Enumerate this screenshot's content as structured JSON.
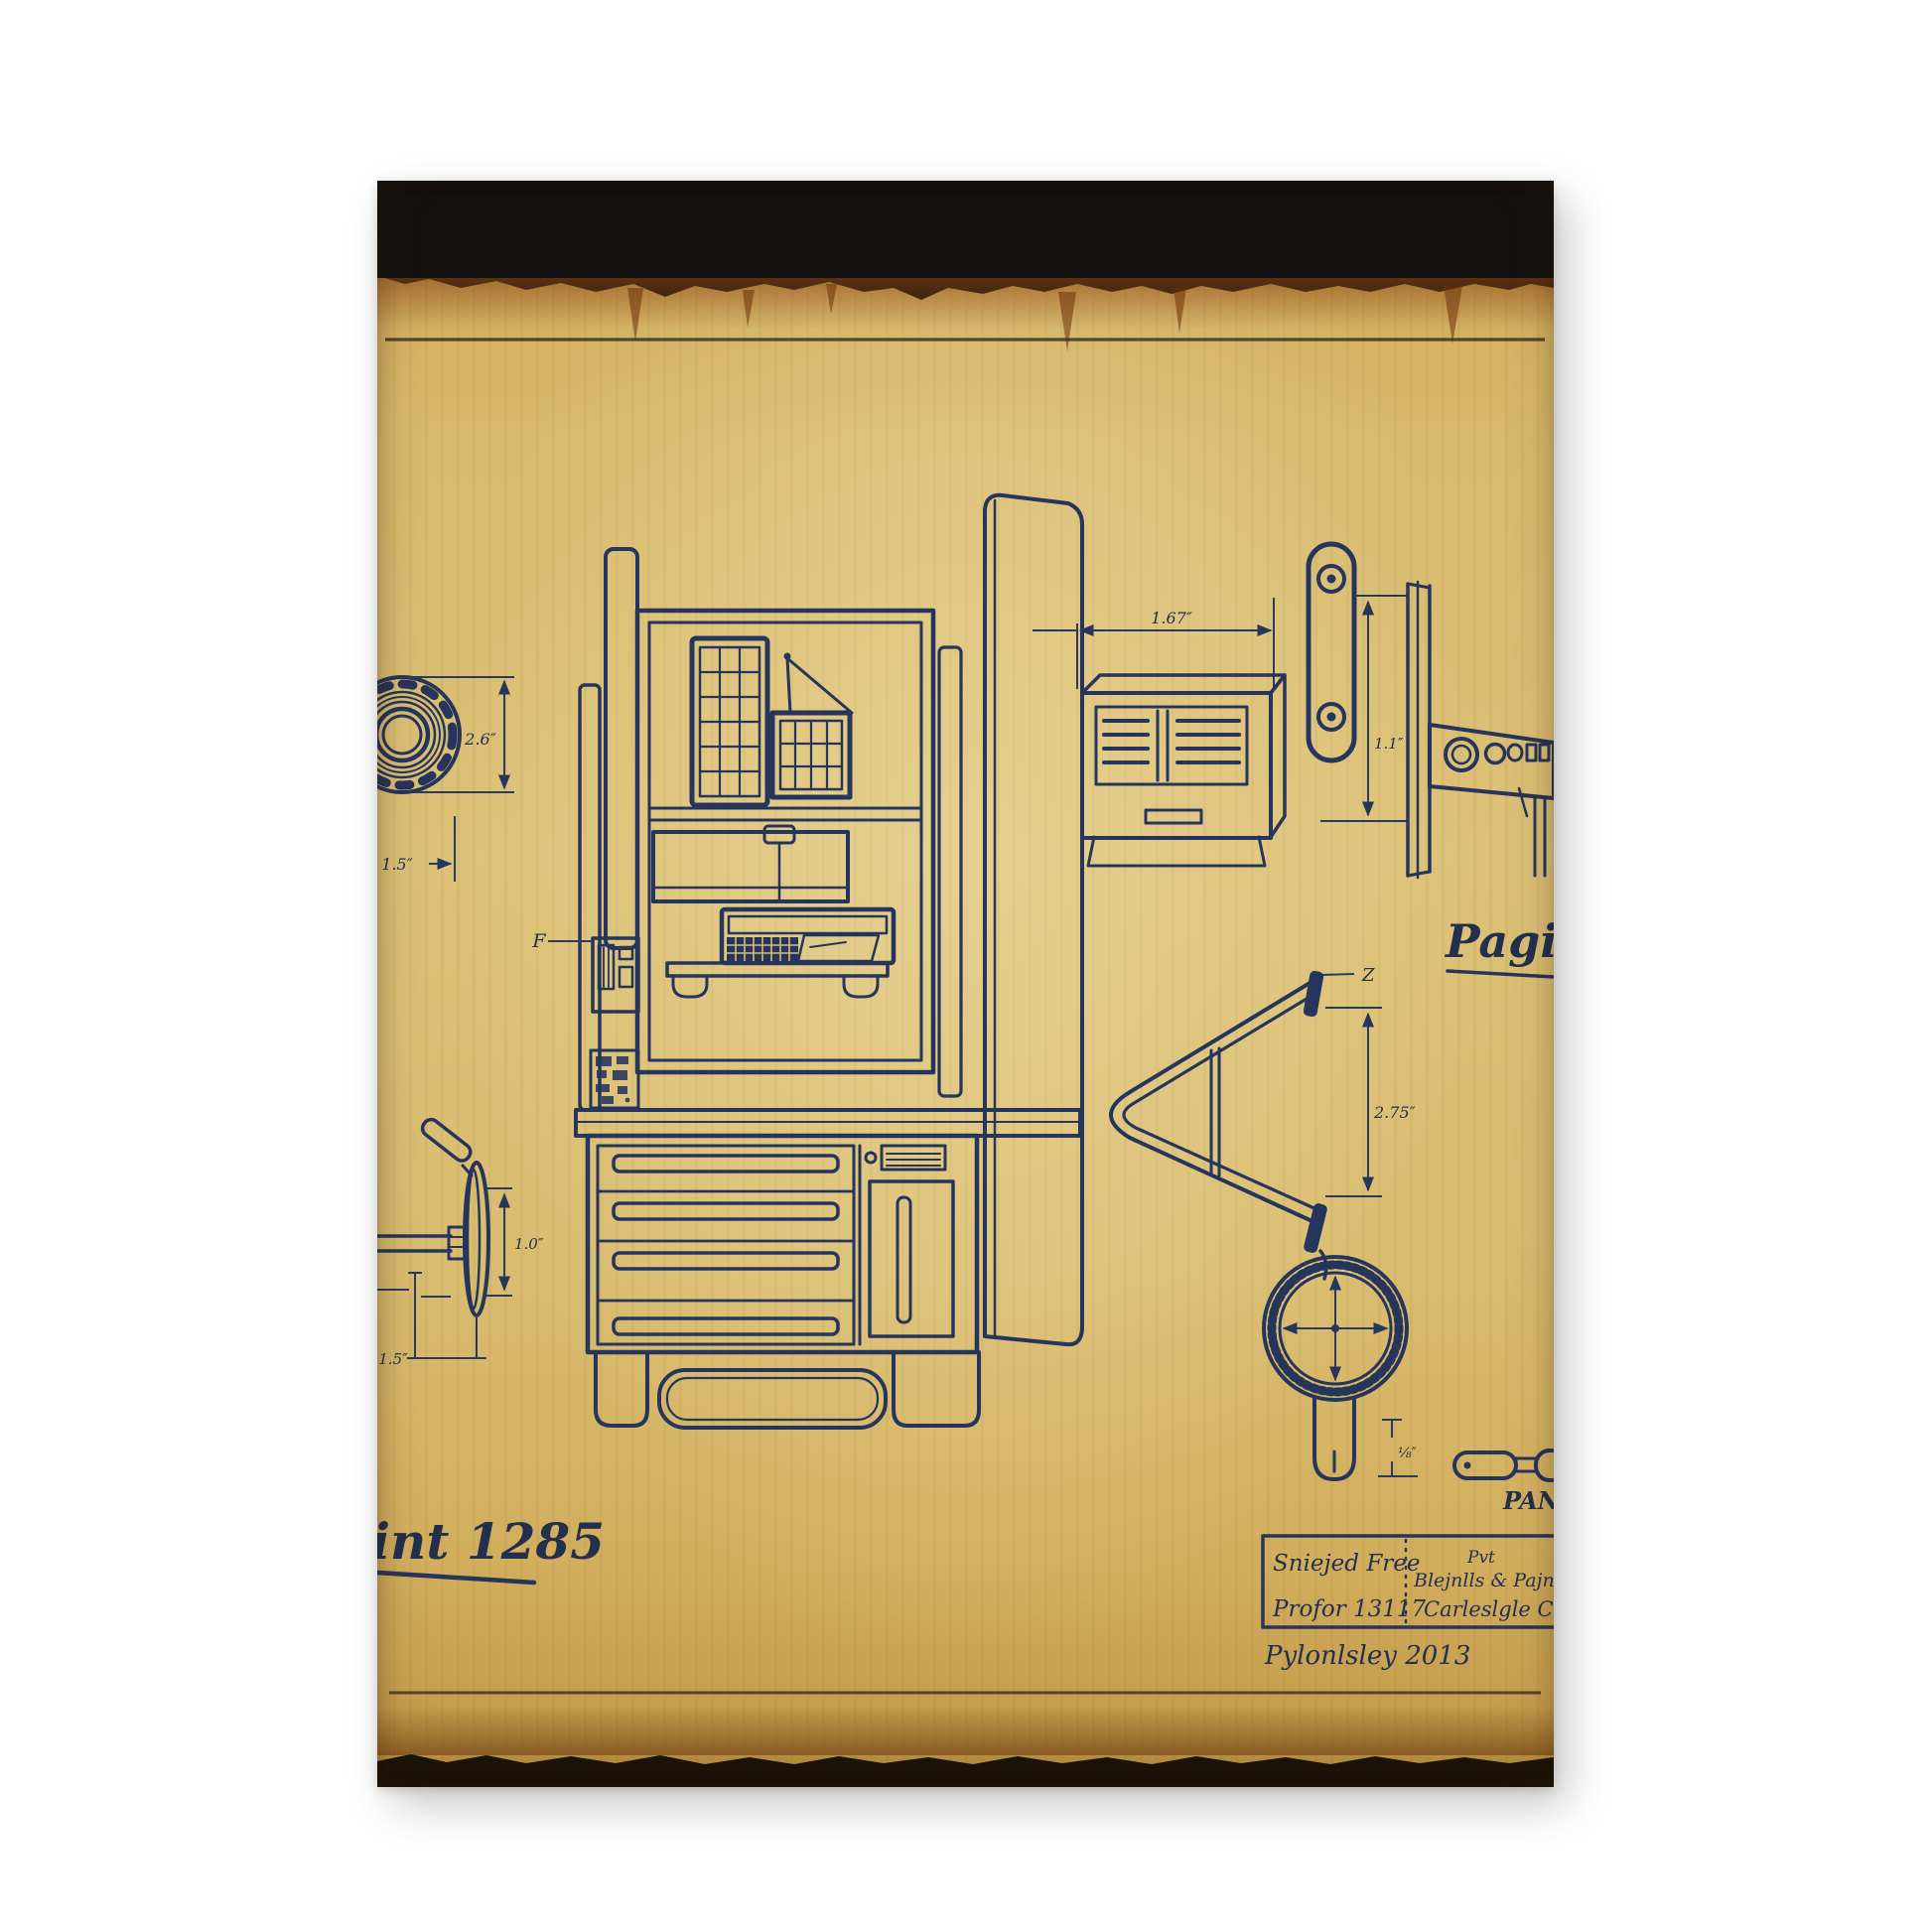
{
  "labels": {
    "flange_height": "2.6″",
    "flange_offset": "1.5″",
    "part_f": "F",
    "wheel_height": "1.0″",
    "wheel_offset": "1.5″",
    "vent_width": "1.67″",
    "link_height": "1.1″",
    "bracket_z": "Z",
    "frame_height": "2.75″",
    "stem_height": "⅛″",
    "pan": "PAN"
  },
  "script_text": {
    "left": "int 1285",
    "right": "Pagin"
  },
  "title_block": {
    "cell_top_left": "Sniejed Free",
    "cell_bottom_left": "Profor 13117",
    "cell_right_line1": "Pvt",
    "cell_right_line2": "Blejnlls & Pajn",
    "cell_right_line3": "Carleslgle Car",
    "signature": "Pylonlsley 2013"
  },
  "colors": {
    "ink": "#26355b",
    "parchment": "#d9bc70",
    "burn": "#151210",
    "rust": "#7a3a10"
  }
}
